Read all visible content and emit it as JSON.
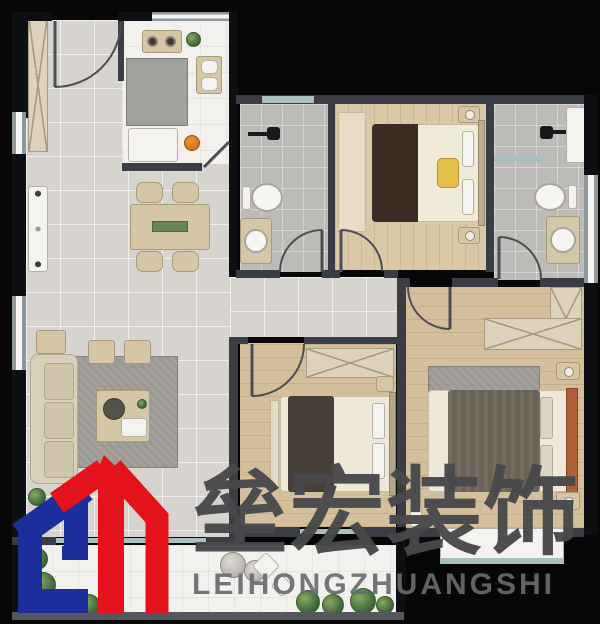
{
  "image_type": "apartment-floor-plan-with-watermark",
  "watermark": {
    "brand_cn": "垒宏装饰",
    "brand_en": "LEIHONGZHUANGSHI",
    "logo_monogram": "GH",
    "logo_colors": {
      "blue": "#1c2d9c",
      "red": "#e4131b"
    },
    "text_colors": {
      "cn": "#48484b",
      "en": "#696c6e"
    }
  },
  "floorplan": {
    "rooms": [
      "entry",
      "kitchen",
      "dining-area",
      "living-room",
      "hallway",
      "bathroom-1",
      "bedroom-1",
      "bathroom-2",
      "bedroom-2",
      "master-bedroom",
      "balcony"
    ],
    "furniture": [
      "entry-door",
      "shoe-cabinet",
      "stove",
      "kitchen-sink",
      "kitchen-island",
      "refrigerator",
      "dining-table",
      "dining-chairs",
      "window-seat",
      "sofa",
      "ottomans",
      "coffee-table",
      "area-rug",
      "wall-tv",
      "toilet",
      "wash-basin",
      "shower-head",
      "double-bed",
      "nightstand",
      "wardrobe",
      "bay-window",
      "balcony-plants",
      "decor-stones"
    ],
    "palette": {
      "background": "#070708",
      "wall": "#3a3e44",
      "wall_exterior": "#0e0f12",
      "tile_gray": "#d7d4cf",
      "tile_white": "#f2f1ed",
      "tile_bath": "#bdbbb7",
      "wood": "#d3bf9b",
      "window_glass": "#a9bfc0",
      "furniture_beige": "#d5c7a5",
      "plant_green": "#41693a",
      "accent_orange": "#e0751f",
      "accent_yellow": "#e6bf4a",
      "headboard_rust": "#ad6136"
    }
  }
}
